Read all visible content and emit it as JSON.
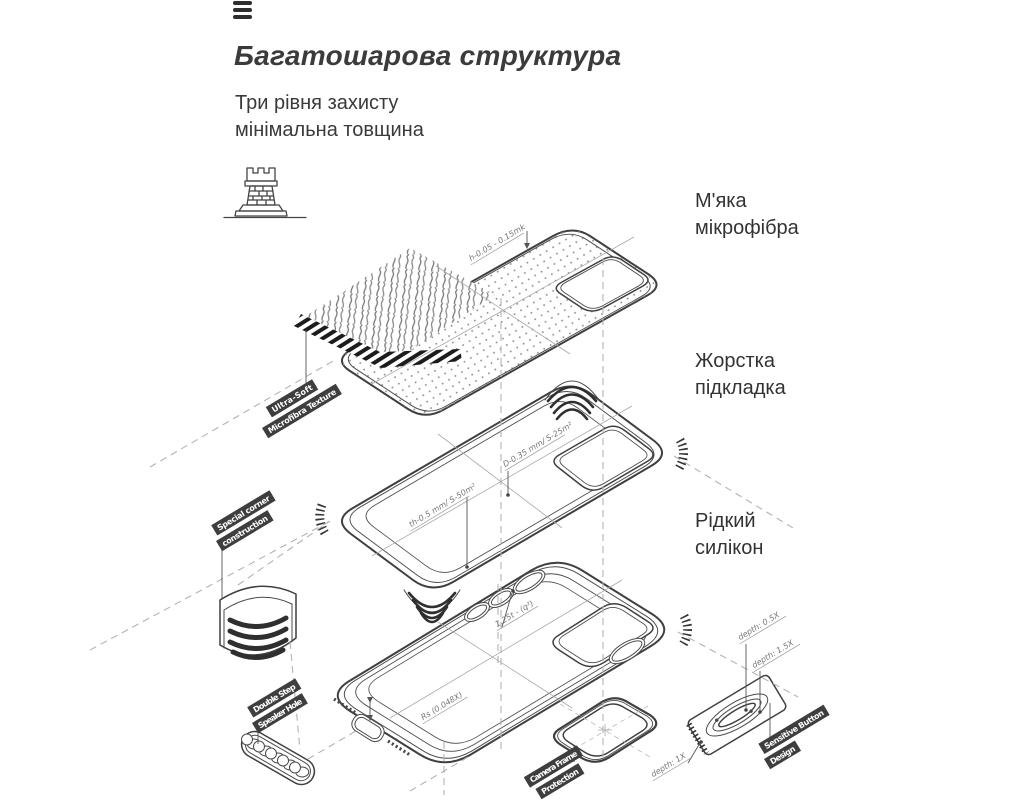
{
  "header": {
    "title": "Багатошарова структура",
    "subtitle_line1": "Три рівня захисту",
    "subtitle_line2": "мінімальна товщина"
  },
  "icons": {
    "menu": "hamburger-menu-icon",
    "fortress": "castle-tower-icon"
  },
  "layer_labels": [
    {
      "line1": "М'яка",
      "line2": "мікрофібра"
    },
    {
      "line1": "Жорстка",
      "line2": "підкладка"
    },
    {
      "line1": "Рідкий",
      "line2": "силікон"
    }
  ],
  "tags": {
    "ultra_soft": {
      "line1": "Ultra-Soft",
      "line2": "Microfibra Texture"
    },
    "corner": {
      "line1": "Special corner",
      "line2": "construction"
    },
    "speaker": {
      "line1": "Double Step",
      "line2": "Speaker Hole"
    },
    "camera": {
      "line1": "Camera Frame",
      "line2": "Protection"
    },
    "button": {
      "line1": "Sensitive Button",
      "line2": "Design"
    }
  },
  "annotations": {
    "microfiber_height": "h-0.05 - 0.15mk",
    "lining_diameter": "D-0.35 mm/ S-25m²",
    "lining_thickness": "th-0.5 mm/ S-50m²",
    "case_thickness": "1.25t - (q²)",
    "case_radius": "Rs (0.048X)",
    "depth_05": "depth: 0.5X",
    "depth_15": "depth: 1.5X",
    "depth_1": "depth: 1X"
  },
  "colors": {
    "ink": "#3f3f3f",
    "guide": "#b3b3b3",
    "tag_bg": "#3e3e3e",
    "tag_text": "#ffffff",
    "text": "#333333"
  }
}
